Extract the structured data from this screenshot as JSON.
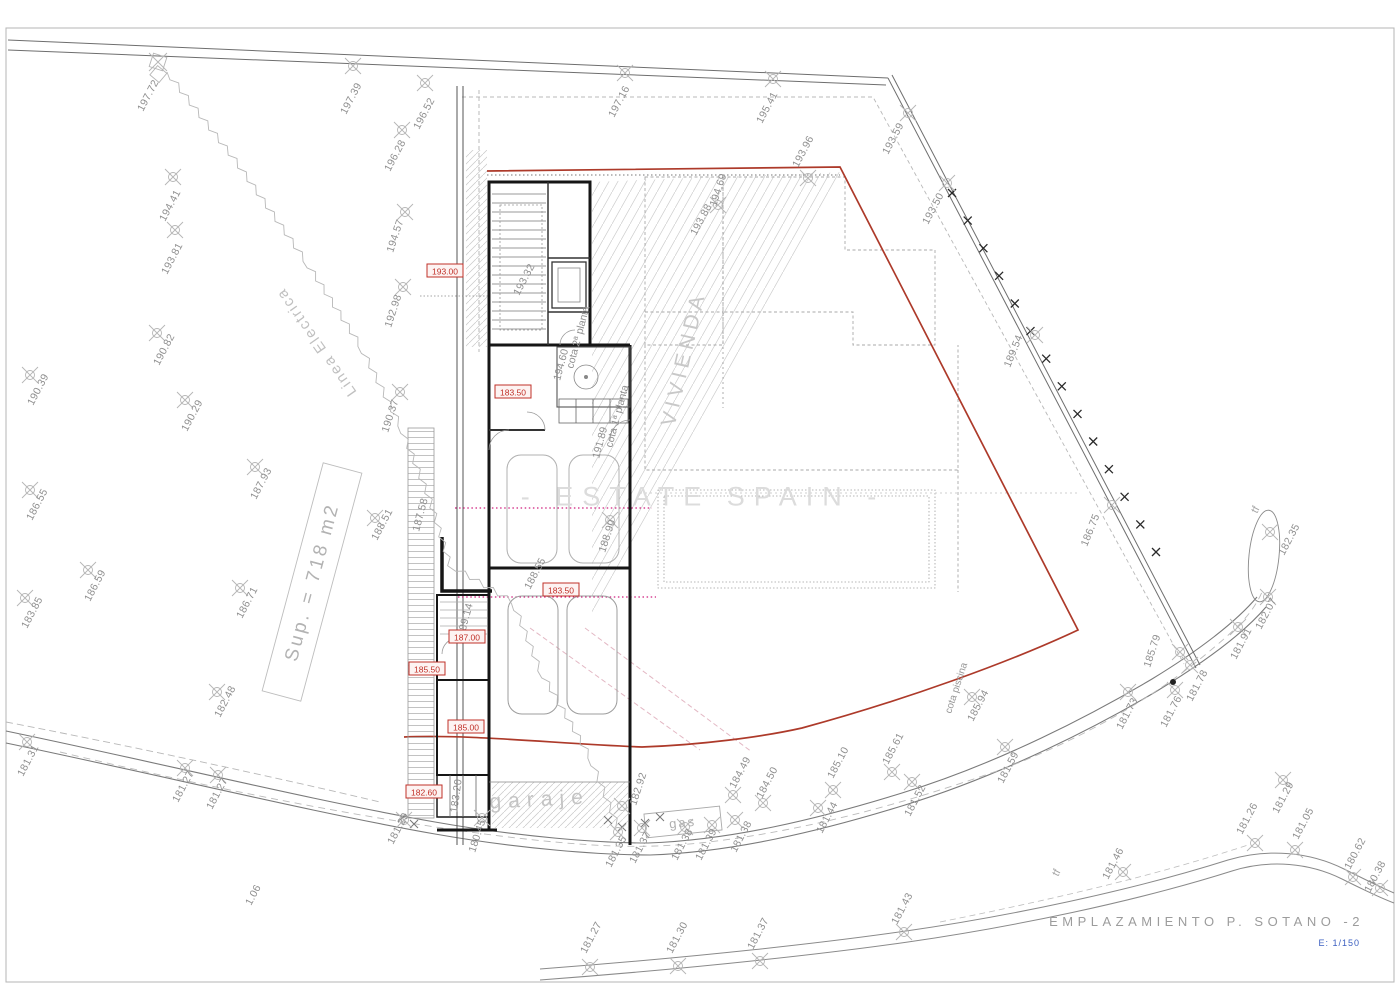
{
  "title_block": {
    "title": "EMPLAZAMIENTO P. SOTANO -2",
    "scale": "E: 1/150"
  },
  "watermark": "- ESTATE SPAIN -",
  "area_label": {
    "text": "Sup. = 718 m2",
    "x": 312,
    "y": 582,
    "rot": -75
  },
  "colors": {
    "red_line": "#ad3a2a",
    "level_red": "#c03028",
    "magenta": "#cf1f7e",
    "scale_blue": "#3b5fc0",
    "label_gray": "#8f8f8f"
  },
  "level_boxes": [
    {
      "v": "193.00",
      "x": 445,
      "y": 271
    },
    {
      "v": "183.50",
      "x": 513,
      "y": 392
    },
    {
      "v": "183.50",
      "x": 561,
      "y": 590
    },
    {
      "v": "187.00",
      "x": 467,
      "y": 637
    },
    {
      "v": "185.50",
      "x": 427,
      "y": 669
    },
    {
      "v": "185.00",
      "x": 466,
      "y": 727
    },
    {
      "v": "182.60",
      "x": 424,
      "y": 792
    }
  ],
  "texts": [
    {
      "t": "VIVIENDA",
      "x": 690,
      "y": 360,
      "r": -77,
      "s": 21,
      "ls": 5,
      "c": "#c8c8c8",
      "a": "m"
    },
    {
      "t": "garaje",
      "x": 540,
      "y": 806,
      "r": -3,
      "s": 21,
      "ls": 7,
      "c": "#c4c4c4",
      "a": "m"
    },
    {
      "t": "gas",
      "x": 683,
      "y": 827,
      "r": -6,
      "s": 13,
      "ls": 2,
      "c": "#b0b0b0",
      "a": "m"
    },
    {
      "t": "Linea Electrica",
      "x": 357,
      "y": 392,
      "r": -125,
      "s": 15,
      "ls": 2,
      "c": "#c0c0c0"
    },
    {
      "t": "cota piscina",
      "x": 951,
      "y": 714,
      "r": -72,
      "s": 10,
      "c": "#969696"
    },
    {
      "t": "191.89",
      "x": 599,
      "y": 459,
      "r": -75,
      "s": 10.5,
      "c": "#8f8f8f"
    },
    {
      "t": "cota 1ª planta",
      "x": 612,
      "y": 448,
      "r": -75,
      "s": 10.5,
      "c": "#8f8f8f"
    },
    {
      "t": "194.60",
      "x": 560,
      "y": 381,
      "r": -75,
      "s": 10.5,
      "c": "#8f8f8f"
    },
    {
      "t": "cota 2ª planta",
      "x": 573,
      "y": 369,
      "r": -75,
      "s": 10.5,
      "c": "#8f8f8f"
    },
    {
      "t": "tf",
      "x": 1257,
      "y": 514,
      "r": -62,
      "s": 11,
      "c": "#a5a5a5"
    },
    {
      "t": "tf",
      "x": 1058,
      "y": 877,
      "r": -62,
      "s": 11,
      "c": "#a5a5a5"
    }
  ],
  "fence": {
    "x1": 952,
    "y1": 193,
    "x2": 1156,
    "y2": 552,
    "n": 14
  },
  "survey_points": [
    {
      "v": "197.72",
      "sx": 158,
      "sy": 62,
      "lx": 143,
      "ly": 112,
      "t": "sq"
    },
    {
      "v": "197.39",
      "sx": 353,
      "sy": 66,
      "lx": 346,
      "ly": 115
    },
    {
      "v": "196.52",
      "sx": 425,
      "sy": 83,
      "lx": 419,
      "ly": 130
    },
    {
      "v": "196.28",
      "sx": 402,
      "sy": 130,
      "lx": 390,
      "ly": 172
    },
    {
      "v": "194.41",
      "sx": 173,
      "sy": 177,
      "lx": 165,
      "ly": 222
    },
    {
      "v": "193.81",
      "sx": 175,
      "sy": 230,
      "lx": 167,
      "ly": 275
    },
    {
      "v": "194.57",
      "sx": 405,
      "sy": 212,
      "lx": 393,
      "ly": 253,
      "r": -72
    },
    {
      "v": "192.98",
      "sx": 403,
      "sy": 287,
      "lx": 391,
      "ly": 328,
      "r": -72
    },
    {
      "v": "190.37",
      "sx": 400,
      "sy": 392,
      "lx": 388,
      "ly": 433,
      "r": -72
    },
    {
      "v": "197.16",
      "sx": 625,
      "sy": 73,
      "lx": 614,
      "ly": 118
    },
    {
      "v": "195.41",
      "sx": 773,
      "sy": 79,
      "lx": 762,
      "ly": 124
    },
    {
      "v": "193.59",
      "sx": 908,
      "sy": 113,
      "lx": 888,
      "ly": 155
    },
    {
      "v": "193.50",
      "sx": 947,
      "sy": 183,
      "lx": 928,
      "ly": 225
    },
    {
      "v": "193.96",
      "sx": 808,
      "sy": 178,
      "lx": 798,
      "ly": 168
    },
    {
      "v": "193.88",
      "sx": 718,
      "sy": 205,
      "lx": 696,
      "ly": 236
    },
    {
      "v": "194.69",
      "lx": 716,
      "ly": 207,
      "r": -72
    },
    {
      "v": "189.54",
      "sx": 1035,
      "sy": 335,
      "lx": 1010,
      "ly": 368,
      "r": -68
    },
    {
      "v": "186.75",
      "sx": 1112,
      "sy": 505,
      "lx": 1087,
      "ly": 547,
      "r": -68
    },
    {
      "v": "185.79",
      "sx": 1180,
      "sy": 652,
      "lx": 1150,
      "ly": 668,
      "r": -72
    },
    {
      "v": "182.35",
      "sx": 1270,
      "sy": 532,
      "lx": 1284,
      "ly": 556
    },
    {
      "v": "182.07",
      "sx": 1268,
      "sy": 597,
      "lx": 1261,
      "ly": 630
    },
    {
      "v": "181.91",
      "sx": 1238,
      "sy": 627,
      "lx": 1236,
      "ly": 660
    },
    {
      "v": "181.78",
      "sx": 1190,
      "sy": 665,
      "lx": 1192,
      "ly": 702
    },
    {
      "v": "181.76",
      "sx": 1175,
      "sy": 690,
      "lx": 1166,
      "ly": 728
    },
    {
      "v": "181.73",
      "sx": 1128,
      "sy": 692,
      "lx": 1122,
      "ly": 730
    },
    {
      "v": "181.29",
      "sx": 1283,
      "sy": 780,
      "lx": 1278,
      "ly": 814
    },
    {
      "v": "181.26",
      "sx": 1255,
      "sy": 843,
      "lx": 1242,
      "ly": 835
    },
    {
      "v": "181.05",
      "sx": 1295,
      "sy": 850,
      "lx": 1298,
      "ly": 840
    },
    {
      "v": "181.46",
      "sx": 1123,
      "sy": 872,
      "lx": 1108,
      "ly": 880
    },
    {
      "v": "180.62",
      "sx": 1353,
      "sy": 877,
      "lx": 1350,
      "ly": 870
    },
    {
      "v": "180.38",
      "sx": 1380,
      "sy": 888,
      "lx": 1370,
      "ly": 893
    },
    {
      "v": "182.92",
      "sx": 622,
      "sy": 806,
      "lx": 636,
      "ly": 806,
      "r": -72
    },
    {
      "v": "181.35",
      "sx": 618,
      "sy": 832,
      "lx": 611,
      "ly": 868
    },
    {
      "v": "181.37",
      "sx": 642,
      "sy": 828,
      "lx": 635,
      "ly": 864
    },
    {
      "v": "181.38",
      "sx": 685,
      "sy": 827,
      "lx": 677,
      "ly": 861
    },
    {
      "v": "181.39",
      "sx": 712,
      "sy": 825,
      "lx": 701,
      "ly": 861
    },
    {
      "v": "181.38",
      "sx": 735,
      "sy": 820,
      "lx": 736,
      "ly": 853
    },
    {
      "v": "184.49",
      "sx": 733,
      "sy": 795,
      "lx": 735,
      "ly": 789
    },
    {
      "v": "184.50",
      "sx": 763,
      "sy": 803,
      "lx": 762,
      "ly": 799
    },
    {
      "v": "185.10",
      "sx": 833,
      "sy": 790,
      "lx": 833,
      "ly": 779
    },
    {
      "v": "185.61",
      "sx": 892,
      "sy": 772,
      "lx": 888,
      "ly": 765
    },
    {
      "v": "181.44",
      "sx": 818,
      "sy": 808,
      "lx": 822,
      "ly": 834
    },
    {
      "v": "181.52",
      "sx": 912,
      "sy": 782,
      "lx": 910,
      "ly": 817
    },
    {
      "v": "181.59",
      "sx": 1005,
      "sy": 747,
      "lx": 1003,
      "ly": 784
    },
    {
      "v": "185.94",
      "sx": 972,
      "sy": 697,
      "lx": 973,
      "ly": 722
    },
    {
      "v": "181.31",
      "sx": 27,
      "sy": 742,
      "lx": 23,
      "ly": 777
    },
    {
      "v": "181.27",
      "sx": 185,
      "sy": 768,
      "lx": 178,
      "ly": 803
    },
    {
      "v": "181.27",
      "sx": 218,
      "sy": 775,
      "lx": 212,
      "ly": 810
    },
    {
      "v": "182.48",
      "sx": 217,
      "sy": 692,
      "lx": 220,
      "ly": 718
    },
    {
      "v": "1.06",
      "lx": 251,
      "ly": 906
    },
    {
      "v": "190.82",
      "sx": 157,
      "sy": 333,
      "lx": 159,
      "ly": 366
    },
    {
      "v": "190.39",
      "sx": 30,
      "sy": 375,
      "lx": 33,
      "ly": 406
    },
    {
      "v": "190.29",
      "sx": 185,
      "sy": 400,
      "lx": 187,
      "ly": 432
    },
    {
      "v": "186.55",
      "sx": 30,
      "sy": 490,
      "lx": 32,
      "ly": 521
    },
    {
      "v": "186.59",
      "sx": 88,
      "sy": 570,
      "lx": 90,
      "ly": 602
    },
    {
      "v": "183.85",
      "sx": 25,
      "sy": 598,
      "lx": 27,
      "ly": 629
    },
    {
      "v": "186.71",
      "sx": 240,
      "sy": 588,
      "lx": 242,
      "ly": 619
    },
    {
      "v": "187.93",
      "sx": 255,
      "sy": 467,
      "lx": 256,
      "ly": 500
    },
    {
      "v": "188.51",
      "sx": 375,
      "sy": 518,
      "lx": 377,
      "ly": 541
    },
    {
      "v": "187.58",
      "lx": 419,
      "ly": 532,
      "r": -75
    },
    {
      "v": "193.32",
      "lx": 519,
      "ly": 296,
      "r": -62
    },
    {
      "v": "188.90",
      "sx": 610,
      "sy": 520,
      "lx": 605,
      "ly": 553,
      "r": -72
    },
    {
      "v": "188.55",
      "lx": 530,
      "ly": 590,
      "r": -62
    },
    {
      "v": "189.14",
      "lx": 464,
      "ly": 637,
      "r": -75
    },
    {
      "v": "183.20",
      "lx": 457,
      "ly": 813,
      "r": -82
    },
    {
      "v": "180.45",
      "sx": 482,
      "sy": 818,
      "lx": 475,
      "ly": 853,
      "r": -72
    },
    {
      "v": "181.29",
      "sx": 404,
      "sy": 820,
      "lx": 393,
      "ly": 845
    },
    {
      "v": "181.27",
      "sx": 590,
      "sy": 967,
      "lx": 586,
      "ly": 954
    },
    {
      "v": "181.30",
      "sx": 678,
      "sy": 966,
      "lx": 672,
      "ly": 954
    },
    {
      "v": "181.37",
      "sx": 760,
      "sy": 961,
      "lx": 753,
      "ly": 950
    },
    {
      "v": "181.43",
      "sx": 904,
      "sy": 932,
      "lx": 897,
      "ly": 925
    }
  ]
}
